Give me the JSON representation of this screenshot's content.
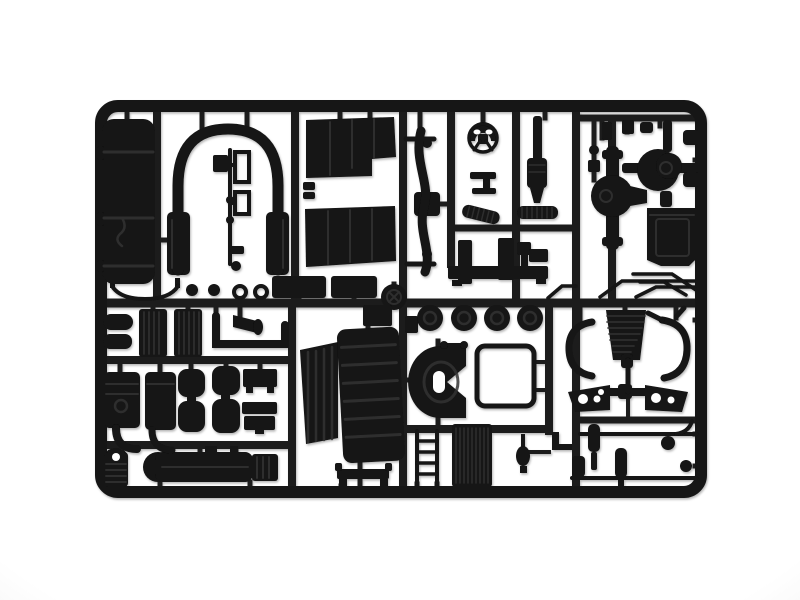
{
  "image": {
    "type": "photograph",
    "subject": "Black injection-molded plastic model kit sprue of truck chassis parts on a white background"
  },
  "colors": {
    "background": "#ffffff",
    "background_edge": "#f7f7f7",
    "plastic": "#121212",
    "runner": "#1e1e1e",
    "frame": "#191919",
    "deep": "#060606",
    "highlight": "#333333"
  },
  "sprue": {
    "material": "black styrene plastic",
    "parts": [
      {
        "name": "fuel-tank",
        "label": "fuel tank with straps"
      },
      {
        "name": "cab-arch-tube",
        "label": "inverted-U cab arch tube with leg pads"
      },
      {
        "name": "pedal-lever-set",
        "label": "pedals, levers and small fittings"
      },
      {
        "name": "cab-floor-panel-upper",
        "label": "cab floor panel (upper)"
      },
      {
        "name": "cab-floor-panel-lower",
        "label": "cab floor panel (lower)"
      },
      {
        "name": "front-axle-beam",
        "label": "curved front axle beam with kingpins"
      },
      {
        "name": "steering-wheel",
        "label": "steering wheel"
      },
      {
        "name": "steering-column",
        "label": "steering column bracket"
      },
      {
        "name": "ribbed-hose-a",
        "label": "ribbed intake hose (angled)"
      },
      {
        "name": "ribbed-hose-b",
        "label": "ribbed intake hose (straight)"
      },
      {
        "name": "bumper-mounts",
        "label": "bumper mounting posts and channel"
      },
      {
        "name": "exhaust-stack",
        "label": "vertical exhaust stack"
      },
      {
        "name": "intake-bracket",
        "label": "intake elbow bracket"
      },
      {
        "name": "differential-front",
        "label": "front differential housing with axle tube"
      },
      {
        "name": "differential-rear",
        "label": "rear differential housing with shafts"
      },
      {
        "name": "battery-box",
        "label": "battery box"
      },
      {
        "name": "thin-linkage-rods",
        "label": "thin linkage rods"
      },
      {
        "name": "curved-strip",
        "label": "thin curved mudguard strip"
      },
      {
        "name": "hub-caps-washers",
        "label": "hub caps and washer rings"
      },
      {
        "name": "step-boxes",
        "label": "cab step boxes"
      },
      {
        "name": "pulley-wheel",
        "label": "spoked pulley wheel"
      },
      {
        "name": "small-air-tanks",
        "label": "small air tanks"
      },
      {
        "name": "ribbed-side-panels",
        "label": "ribbed side panels"
      },
      {
        "name": "air-horn",
        "label": "air horn"
      },
      {
        "name": "exhaust-u-pipe",
        "label": "square U exhaust pipe"
      },
      {
        "name": "engine-cylinder-1",
        "label": "engine cylinder with elbow pipe"
      },
      {
        "name": "engine-cylinder-2",
        "label": "engine cylinder with elbow pipe"
      },
      {
        "name": "air-reservoir-pair-1",
        "label": "twin air reservoirs"
      },
      {
        "name": "air-reservoir-pair-2",
        "label": "twin air reservoirs"
      },
      {
        "name": "chassis-bracket-1",
        "label": "chassis bracket plate"
      },
      {
        "name": "chassis-bracket-2",
        "label": "stacked bracket plates"
      },
      {
        "name": "air-filter",
        "label": "ribbed air filter canister"
      },
      {
        "name": "muffler",
        "label": "long muffler with domed end"
      },
      {
        "name": "side-grille",
        "label": "slatted side grille panel"
      },
      {
        "name": "front-grille",
        "label": "large ribbed front grille panel"
      },
      {
        "name": "fifth-wheel",
        "label": "fifth wheel coupling plate"
      },
      {
        "name": "window-frame",
        "label": "open rectangular window frame"
      },
      {
        "name": "wheel-hubs",
        "label": "four wheel hub discs"
      },
      {
        "name": "ladder",
        "label": "access ladder"
      },
      {
        "name": "radiator",
        "label": "finned radiator core"
      },
      {
        "name": "mirror",
        "label": "mirror with stem"
      },
      {
        "name": "front-bumper",
        "label": "front bumper with feet"
      },
      {
        "name": "leaf-spring",
        "label": "leaf spring stack"
      },
      {
        "name": "spring-brackets",
        "label": "C-shaped spring shackle brackets"
      },
      {
        "name": "control-arms",
        "label": "suspension control arms with holes"
      },
      {
        "name": "tie-rod-assembly",
        "label": "tie rod with eye ring"
      },
      {
        "name": "shock-absorber-rods",
        "label": "linkage rods with shock absorbers"
      }
    ]
  }
}
